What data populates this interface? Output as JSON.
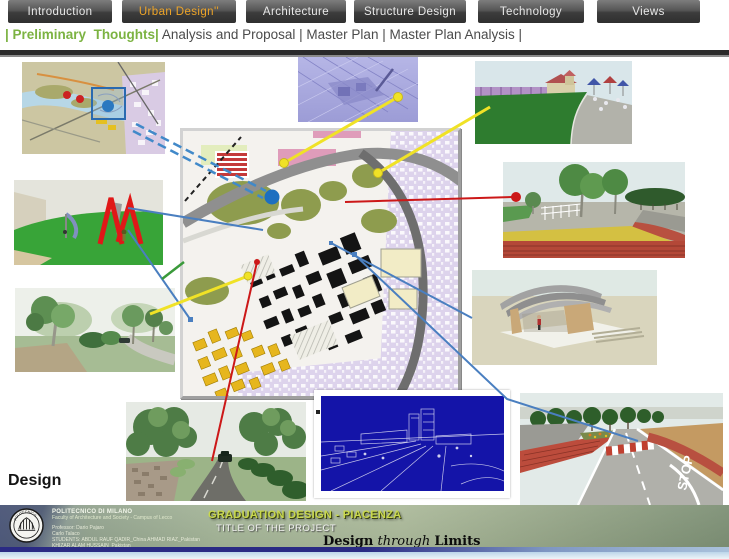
{
  "nav": {
    "tabs": [
      {
        "label": "Introduction",
        "active": false
      },
      {
        "label": "Urban Design''",
        "active": true
      },
      {
        "label": "Architecture",
        "active": false
      },
      {
        "label": "Structure Design",
        "active": false
      },
      {
        "label": "Technology",
        "active": false
      },
      {
        "label": "Views",
        "active": false
      }
    ]
  },
  "subnav": {
    "highlight": "| Preliminary  Thoughts|",
    "rest": " Analysis and Proposal | Master Plan | Master Plan Analysis |"
  },
  "content": {
    "design_label": "Design",
    "street_stop_text": "STOP"
  },
  "footer": {
    "institution": "POLITECNICO DI MILANO",
    "faculty": "Faculty of Architecture and Society - Campus of Lecco",
    "line3": "Professor: Dario Pajaro",
    "line4": "Carlo Talaco",
    "line5": "STUDENTS: ABDUL RAUF QADIR_China    AHMAD RIAZ_Pakistan",
    "line6": "KHIZAR ALAM HUSSAIN_Pakistan",
    "title": "GRADUATION DESIGN - PIACENZA",
    "subtitle": "TITLE OF THE PROJECT",
    "motto_w1": "Design",
    "motto_w2": "through",
    "motto_w3": "Limits"
  },
  "colors": {
    "nav_active": "#eda428",
    "subnav_green": "#7cb342",
    "connector_blue": "#4a7fc0",
    "connector_red": "#cc1818",
    "connector_yellow": "#f0e226",
    "connector_green": "#3a9a3a",
    "map_dot_blue": "#1d6fc0"
  }
}
